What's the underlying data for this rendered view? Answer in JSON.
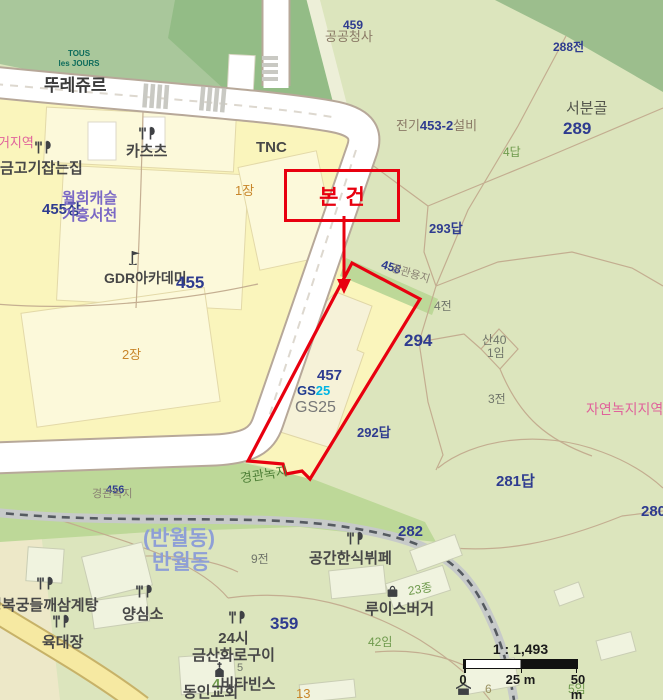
{
  "colors": {
    "red": "#E8000F",
    "navy": "#2E3B8F",
    "text": "#474747",
    "subtext": "#70756A",
    "green": "#6F9A4D",
    "green_dark": "#4F8038",
    "pink": "#E0629B",
    "purple": "#7A68C5",
    "orange": "#C8862A",
    "dong_blue": "#8E9FD6",
    "teal": "#0C6B5B",
    "gs_blue": "#1E3A8F",
    "gs_cyan": "#00B4E3",
    "zone_gray": "#8A8273",
    "brown_gray": "#8A7A66",
    "olive_num": "#9A9160"
  },
  "callout": {
    "label": "본건"
  },
  "scalebar": {
    "ratio": "1 : 1,493",
    "tick0": "0",
    "tick25": "25 m",
    "tick50": "50 m"
  },
  "pois": {
    "tous": {
      "line1": "TOUS",
      "line2": "les JOURS"
    },
    "toureju": {
      "text": "뚜레쥬르"
    },
    "katsu": {
      "text": "카츠츠"
    },
    "tnc": {
      "text": "TNC"
    },
    "geumgogi": {
      "text": "금고기잡는집"
    },
    "wolhee": {
      "line1": "월희캐슬",
      "line2": "기흥서천"
    },
    "gdr": {
      "text": "GDR아카데미"
    },
    "gs25_logo": {
      "gs": "GS",
      "n25": "25"
    },
    "gs25_name": {
      "text": "GS25"
    },
    "gonggan": {
      "text": "공간한식뷔페"
    },
    "louis": {
      "text": "루이스버거"
    },
    "yangsimso": {
      "text": "양심소"
    },
    "yukdaejang": {
      "text": "육대장"
    },
    "gyeongbokgung": {
      "text": "경복궁들깨삼계탕"
    },
    "geumsan": {
      "line1": "24시",
      "line2": "금산화로구이"
    },
    "vitabins": {
      "prefix": "4",
      "text": "비타빈스"
    },
    "dongin": {
      "text": "동인교회"
    }
  },
  "zones": {
    "jugeo": {
      "text": "주거지역"
    },
    "nokji": {
      "text": "자연녹지지역"
    },
    "seobungol": {
      "text": "서분골"
    },
    "banwol1": {
      "text": "(반월동)"
    },
    "banwol2": {
      "text": "반월동"
    },
    "gyeong_green": {
      "text": "경관녹지"
    },
    "gyeong_strip": {
      "text": "경관용지"
    },
    "gyeong_bottom": {
      "text": "경관녹지"
    },
    "gonggong": {
      "text": "공공청사"
    },
    "electric": {
      "prefix": "전기",
      "num": "453-2",
      "suffix": "설비"
    }
  },
  "parcels": {
    "p455jang": "455장",
    "p455": "455",
    "p457": "457",
    "p458": "458",
    "p456": "456",
    "p459": "459",
    "p1jang": "1장",
    "p2jang": "2장",
    "p288": "288전",
    "p289": "289",
    "p4dap": "4답",
    "p293": "293답",
    "p4jeon": "4전",
    "p294": "294",
    "san40": "산40",
    "p1im": "1임",
    "p3jeon": "3전",
    "p292": "292답",
    "p281": "281답",
    "p280": "280",
    "p282": "282",
    "p23": "23종",
    "p9jeon": "9전",
    "p359": "359",
    "p42im": "42임",
    "p5im": "5임",
    "p6": "6",
    "p13": "13",
    "p5": "5"
  }
}
